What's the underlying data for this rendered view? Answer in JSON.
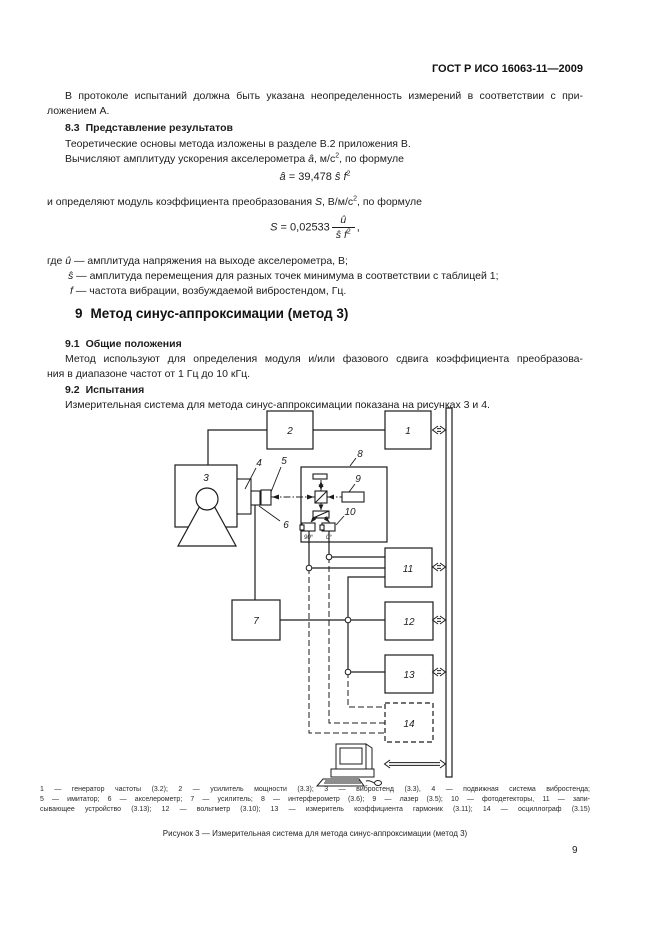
{
  "page": {
    "header": "ГОСТ Р ИСО 16063-11—2009",
    "page_number": "9"
  },
  "text": {
    "p1_line1": "В протоколе испытаний должна быть указана неопределенность измерений в соответствии с при-",
    "p1_line2": "ложением А.",
    "h83": {
      "num": "8.3",
      "title": "Представление результатов"
    },
    "p2": "Теоретические основы метода изложены в разделе В.2 приложения В.",
    "p3_segs": [
      "Вычисляют амплитуду ускорения акселерометра ",
      "â",
      ", м/с",
      "2",
      ", по формуле"
    ],
    "p4_segs": [
      "и определяют модуль коэффициента преобразования ",
      "S",
      ", В/м/с",
      "2",
      ", по формуле"
    ],
    "where": [
      {
        "pre": "где ",
        "var": "û",
        "rest": " — амплитуда напряжения на выходе акселерометра, В;"
      },
      {
        "pre": "",
        "var": "ŝ",
        "rest": " — амплитуда перемещения для разных точек минимума в соответствии с таблицей 1;"
      },
      {
        "pre": "",
        "var": "f",
        "rest": " — частота вибрации, возбуждаемой вибростендом, Гц."
      }
    ],
    "h9": {
      "num": "9",
      "title": "Метод синус-аппроксимации (метод 3)"
    },
    "h91": {
      "num": "9.1",
      "title": "Общие положения"
    },
    "p5_line1": "Метод используют для определения модуля и/или фазового сдвига коэффициента преобразова-",
    "p5_line2": "ния в диапазоне частот от 1 Гц до 10 кГц.",
    "h92": {
      "num": "9.2",
      "title": "Испытания"
    },
    "p6": "Измерительная система для метода синус-аппроксимации показана на рисунках 3 и 4."
  },
  "formula1": {
    "lhs": "â",
    "eq": " = ",
    "coef": "39,478 ",
    "s": "ŝ ",
    "f": "f",
    "sup": "2"
  },
  "formula2": {
    "lhs": "S",
    "eq": " = ",
    "coef": "0,02533",
    "num": "û",
    "den_s": "ŝ ",
    "den_f": "f",
    "den_sup": "2",
    "tail": ","
  },
  "diagram": {
    "labels": {
      "b1": "1",
      "b2": "2",
      "b3": "3",
      "b4": "4",
      "b5": "5",
      "b6": "6",
      "b7": "7",
      "b8": "8",
      "b9": "9",
      "b10": "10",
      "b11": "11",
      "b12": "12",
      "b13": "13",
      "b14": "14",
      "deg90": "90°",
      "deg0": "0°"
    },
    "caption_lines": [
      "1 — генератор частоты (3.2); 2 — усилитель мощности (3.3); 3 — вибростенд (3.3), 4 — подвижная система вибростенда;",
      "5 — имитатор; 6 — акселерометр; 7 — усилитель; 8 — интерферометр (3.6); 9 — лазер (3.5); 10 — фотодетекторы, 11 — запи-",
      "сывающее устройство (3.13); 12 — вольтметр (3.10); 13 — измеритель коэффициента гармоник (3.11); 14 — осциллограф (3.15)"
    ],
    "figure_caption": "Рисунок 3 — Измерительная система для метода синус-аппроксимации (метод 3)"
  }
}
